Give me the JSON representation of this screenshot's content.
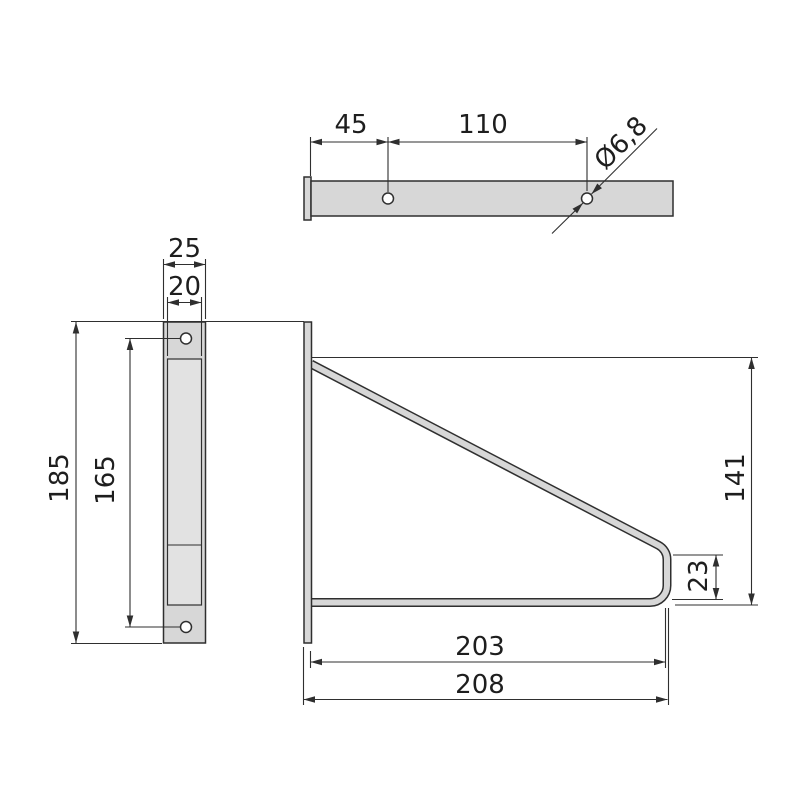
{
  "drawing": {
    "kind": "technical-dimension-drawing",
    "subject": "wall shelf bracket",
    "colors": {
      "background": "#ffffff",
      "part_fill": "#d7d7d7",
      "part_fill_light": "#e2e2e2",
      "line": "#2f2f2f",
      "text": "#1e1e1e"
    },
    "views": {
      "top": {
        "dims": [
          {
            "name": "plate-face-to-first-hole",
            "label": "45"
          },
          {
            "name": "hole-to-hole-spacing",
            "label": "110"
          },
          {
            "name": "hole-diameter",
            "label": "Ø6,8"
          }
        ]
      },
      "side": {
        "dims": [
          {
            "name": "outer-width",
            "label": "25"
          },
          {
            "name": "slot-width",
            "label": "20"
          },
          {
            "name": "overall-height",
            "label": "185"
          },
          {
            "name": "hole-spacing",
            "label": "165"
          }
        ]
      },
      "front": {
        "dims": [
          {
            "name": "brace-height",
            "label": "141"
          },
          {
            "name": "end-drop",
            "label": "23"
          },
          {
            "name": "arm-length",
            "label": "203"
          },
          {
            "name": "overall-depth",
            "label": "208"
          }
        ]
      }
    }
  }
}
